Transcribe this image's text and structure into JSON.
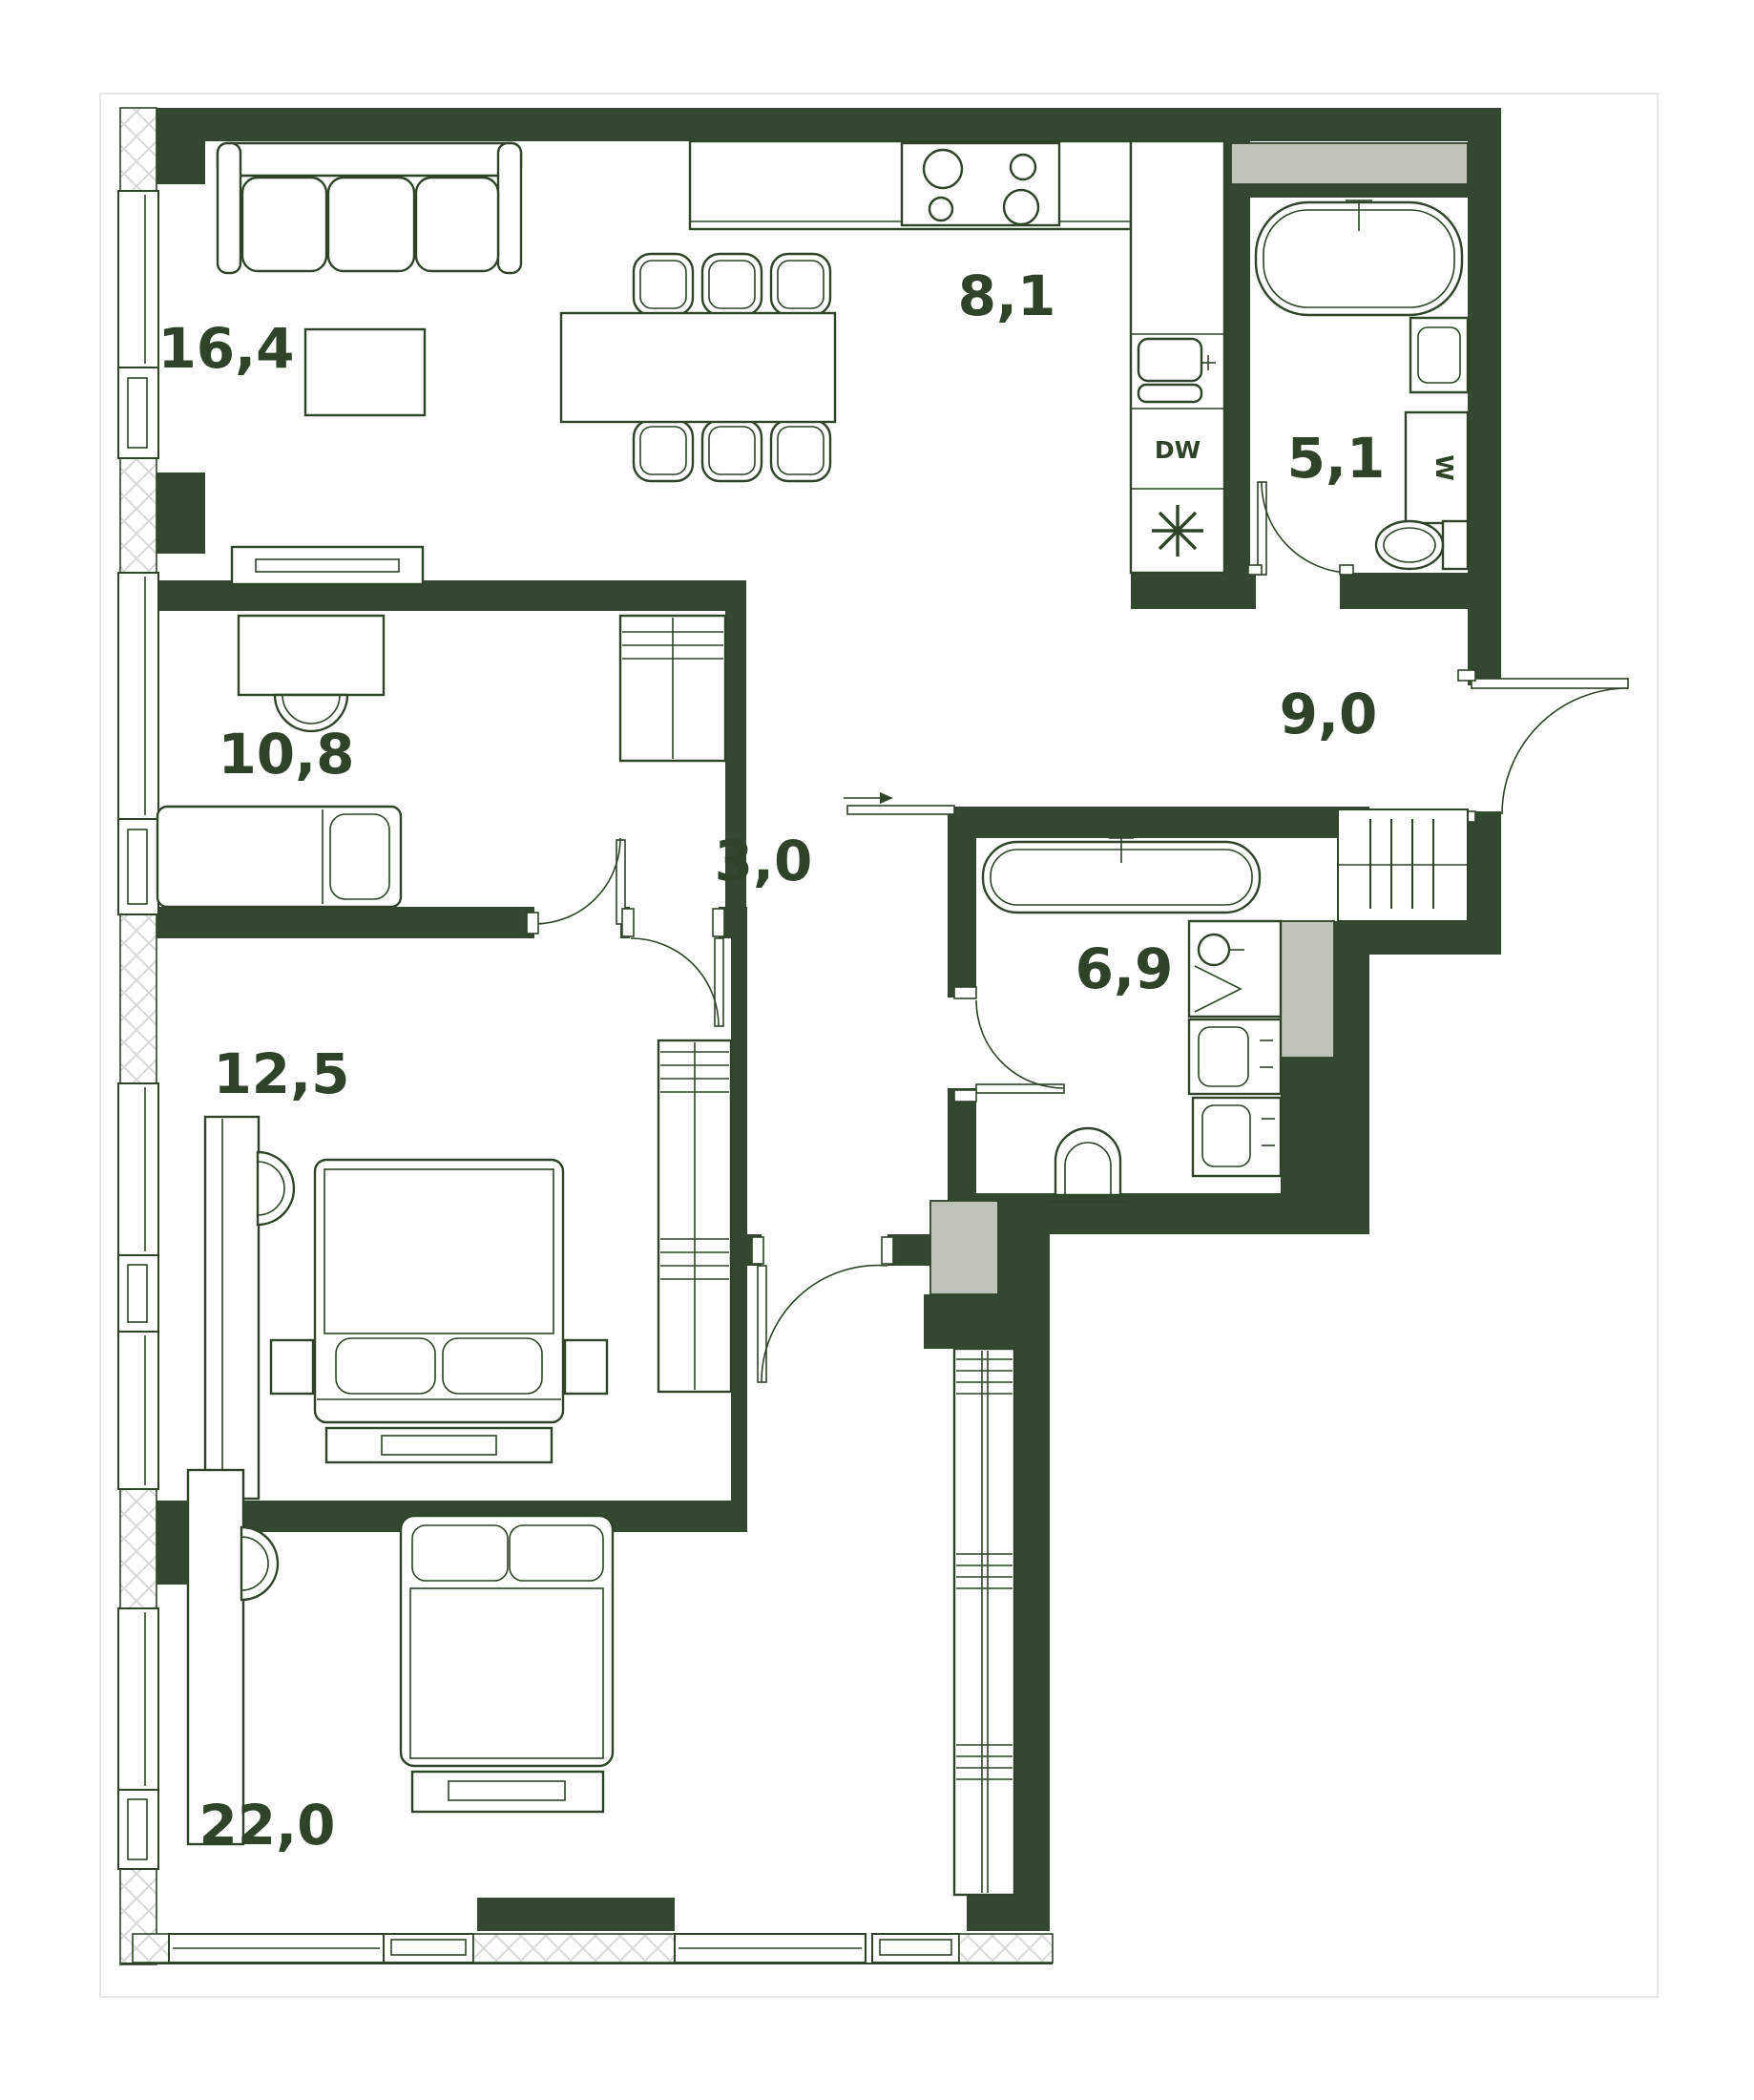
{
  "plan": {
    "colors": {
      "wall": "#344731",
      "line": "#2f4329",
      "shaft": "#bdc3b6",
      "hatch": "#d8d8d8",
      "frame": "#e7e7e7",
      "bg": "#ffffff"
    },
    "rooms": {
      "living": {
        "area": "16,4"
      },
      "kitchen": {
        "area": "8,1"
      },
      "bath_small": {
        "area": "5,1"
      },
      "office": {
        "area": "10,8"
      },
      "hall": {
        "area": "9,0"
      },
      "inner_hall": {
        "area": "3,0"
      },
      "bath_big": {
        "area": "6,9"
      },
      "bedroom": {
        "area": "12,5"
      },
      "bedroom_master": {
        "area": "22,0"
      }
    },
    "appliances": {
      "dishwasher": "DW",
      "washer": "W"
    }
  }
}
